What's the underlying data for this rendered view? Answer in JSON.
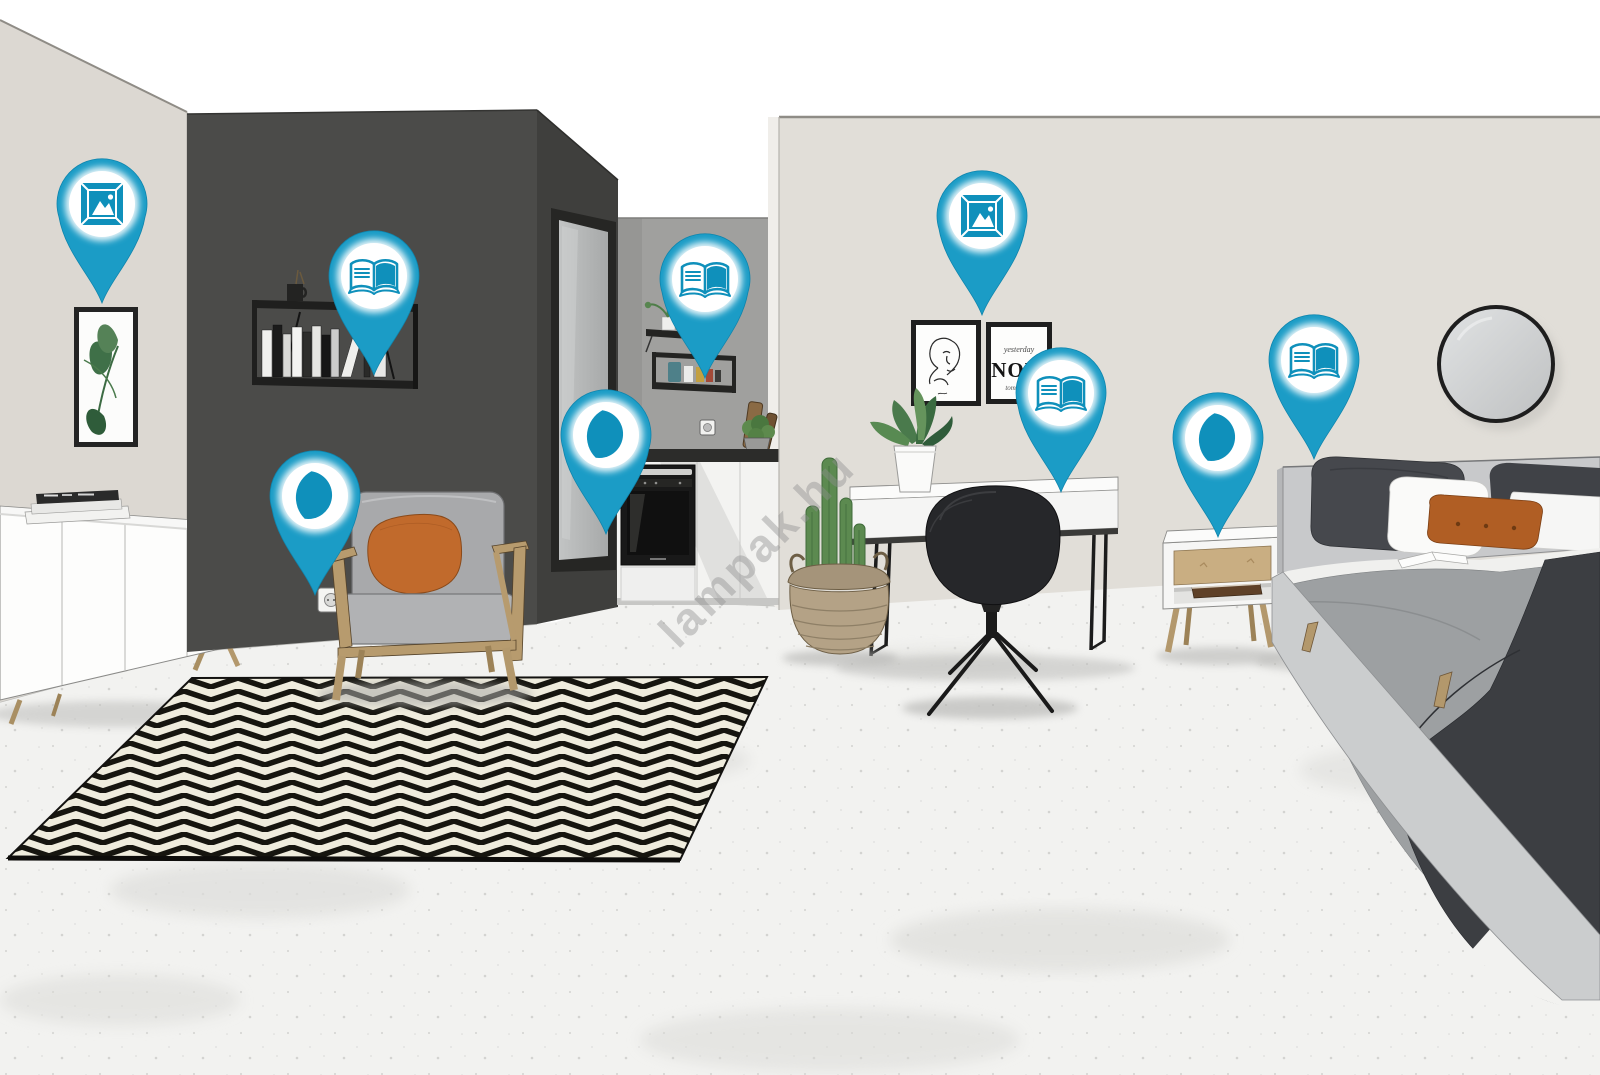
{
  "app": {
    "name": "Interactive room hotspot visualization",
    "watermark": "lampak.hu"
  },
  "poster": {
    "line1": "yesterday",
    "line2": "NOW",
    "line3": "tomorrow"
  },
  "icon_legend": {
    "icon-picture": "framed wall-art icon",
    "icon-book": "open book icon",
    "icon-moon": "crescent moon night-light icon"
  },
  "pins": [
    {
      "name": "wall-art-hotspot-left",
      "icon": "icon-picture",
      "x": 102,
      "y": 303
    },
    {
      "name": "bookshelf-hotspot",
      "icon": "icon-book",
      "x": 374,
      "y": 375
    },
    {
      "name": "reading-light-hotspot-lounge",
      "icon": "icon-moon",
      "x": 315,
      "y": 595
    },
    {
      "name": "doorway-light-hotspot",
      "icon": "icon-moon",
      "x": 606,
      "y": 534
    },
    {
      "name": "kitchen-shelf-hotspot",
      "icon": "icon-book",
      "x": 705,
      "y": 378
    },
    {
      "name": "wall-art-hotspot-bedroom",
      "icon": "icon-picture",
      "x": 982,
      "y": 315
    },
    {
      "name": "desk-books-hotspot",
      "icon": "icon-book",
      "x": 1061,
      "y": 492
    },
    {
      "name": "nightstand-light-hotspot",
      "icon": "icon-moon",
      "x": 1218,
      "y": 537
    },
    {
      "name": "bedside-books-hotspot",
      "icon": "icon-book",
      "x": 1314,
      "y": 459
    }
  ],
  "colors": {
    "pin_teal": "#1b9cc6",
    "pin_icon_teal": "#0f90bb",
    "accent_orange": "#c16a2c",
    "dark_wall": "#4b4b49",
    "left_wall": "#dcd8d2",
    "right_wall": "#e1ded8",
    "kitchen_wall": "#a0a09e",
    "floor": "#f2f2f0",
    "rug_black": "#16150f",
    "rug_cream": "#efecdd"
  }
}
